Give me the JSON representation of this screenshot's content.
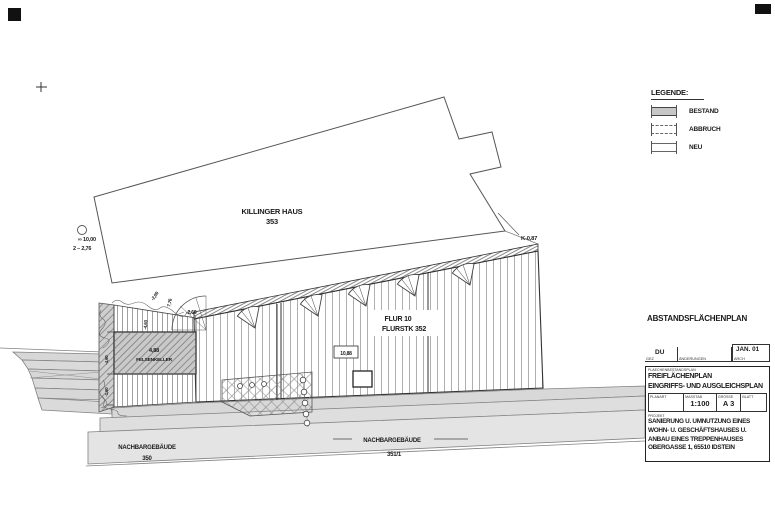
{
  "legend": {
    "title": "LEGENDE:",
    "items": [
      {
        "label": "BESTAND"
      },
      {
        "label": "ABBRUCH"
      },
      {
        "label": "NEU"
      }
    ]
  },
  "titleblock": {
    "heading": "ABSTANDSFLÄCHENPLAN",
    "sign_row": {
      "gez_label": "GEZ",
      "gez_value": "DU",
      "changes_label": "ÄNDERUNGEN",
      "date_value": "JAN. 01",
      "date_label": "ARCH"
    },
    "section_label": "FLAECHENBESTANDSPLAN",
    "plan_title_line1": "FREIFLÄCHENPLAN",
    "plan_title_line2": "EINGRIFFS- UND AUSGLEICHSPLAN",
    "table": {
      "headers": [
        "PLANART",
        "MASSTAB",
        "GRÖSSE",
        "BLATT"
      ],
      "values": [
        "",
        "1:100",
        "A 3",
        ""
      ]
    },
    "project_label": "PROJEKT",
    "project_lines": [
      "SANIERUNG U. UMNUTZUNG EINES",
      "WOHN- U. GESCHÄFTSHAUSES U.",
      "ANBAU EINES TREPPENHAUSES",
      "OBERGASSE 1, 65510 IDSTEIN"
    ]
  },
  "plan": {
    "killinger_name": "KILLINGER HAUS",
    "killinger_number": "353",
    "flur_line1": "FLUR 10",
    "flur_line2": "FLURSTK 352",
    "cellar_value": "4,88",
    "cellar_label": "FELSENKELLER",
    "neighbor_left_name": "NACHBARGEBÄUDE",
    "neighbor_left_number": "350",
    "neighbor_right_name": "NACHBARGEBÄUDE",
    "neighbor_right_number": "351/1",
    "corner_annotation": "K-0,87",
    "datum_line1": "∞ 10,00",
    "datum_line2": "2 – 2,76",
    "dim_a": "-2,66",
    "dim_b": "-2,09",
    "dim_c": "7,76",
    "dim_d": "-4,60",
    "dim_e": "-1,60",
    "roof_box_label": "10,88"
  }
}
